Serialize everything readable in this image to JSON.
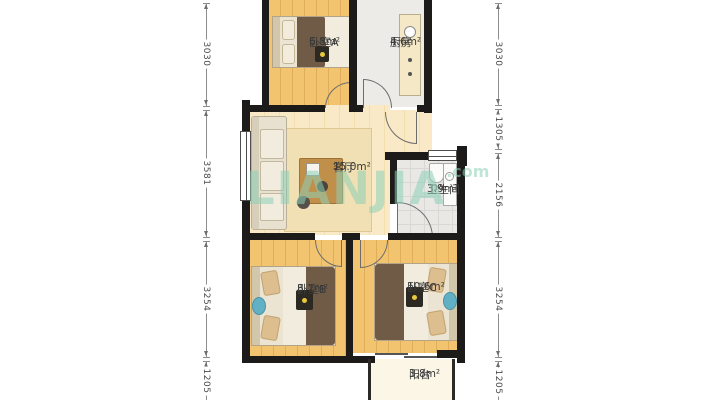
{
  "watermark": {
    "brand": "LIANJIA",
    "suffix": ".com"
  },
  "rooms": {
    "bedroomA": {
      "name": "卧室A",
      "area": "6.8m²"
    },
    "kitchen": {
      "name": "厨房",
      "area": "4.6m²"
    },
    "living": {
      "name": "客厅",
      "area": "15.0m²"
    },
    "bathroom": {
      "name": "卫生间",
      "area": "3.9m²"
    },
    "bedroomB": {
      "name": "卧室B",
      "area": "8.7m²"
    },
    "bedroomC": {
      "name": "卧室C",
      "area": "10.6m²"
    },
    "balcony": {
      "name": "阳台",
      "area": "3.8m²"
    }
  },
  "dimensions": {
    "left": [
      "3030",
      "3581",
      "3254",
      "1205"
    ],
    "right": [
      "3030",
      "1305",
      "2156",
      "3254",
      "1205"
    ]
  },
  "colors": {
    "wall": "#1d1b19",
    "wood_floor": "#f2c46f",
    "living_floor": "#f8e7c0",
    "tile_floor": "#e9e8e4",
    "balcony_floor": "#fbf6e6",
    "watermark_green": "#8cd0b6"
  }
}
